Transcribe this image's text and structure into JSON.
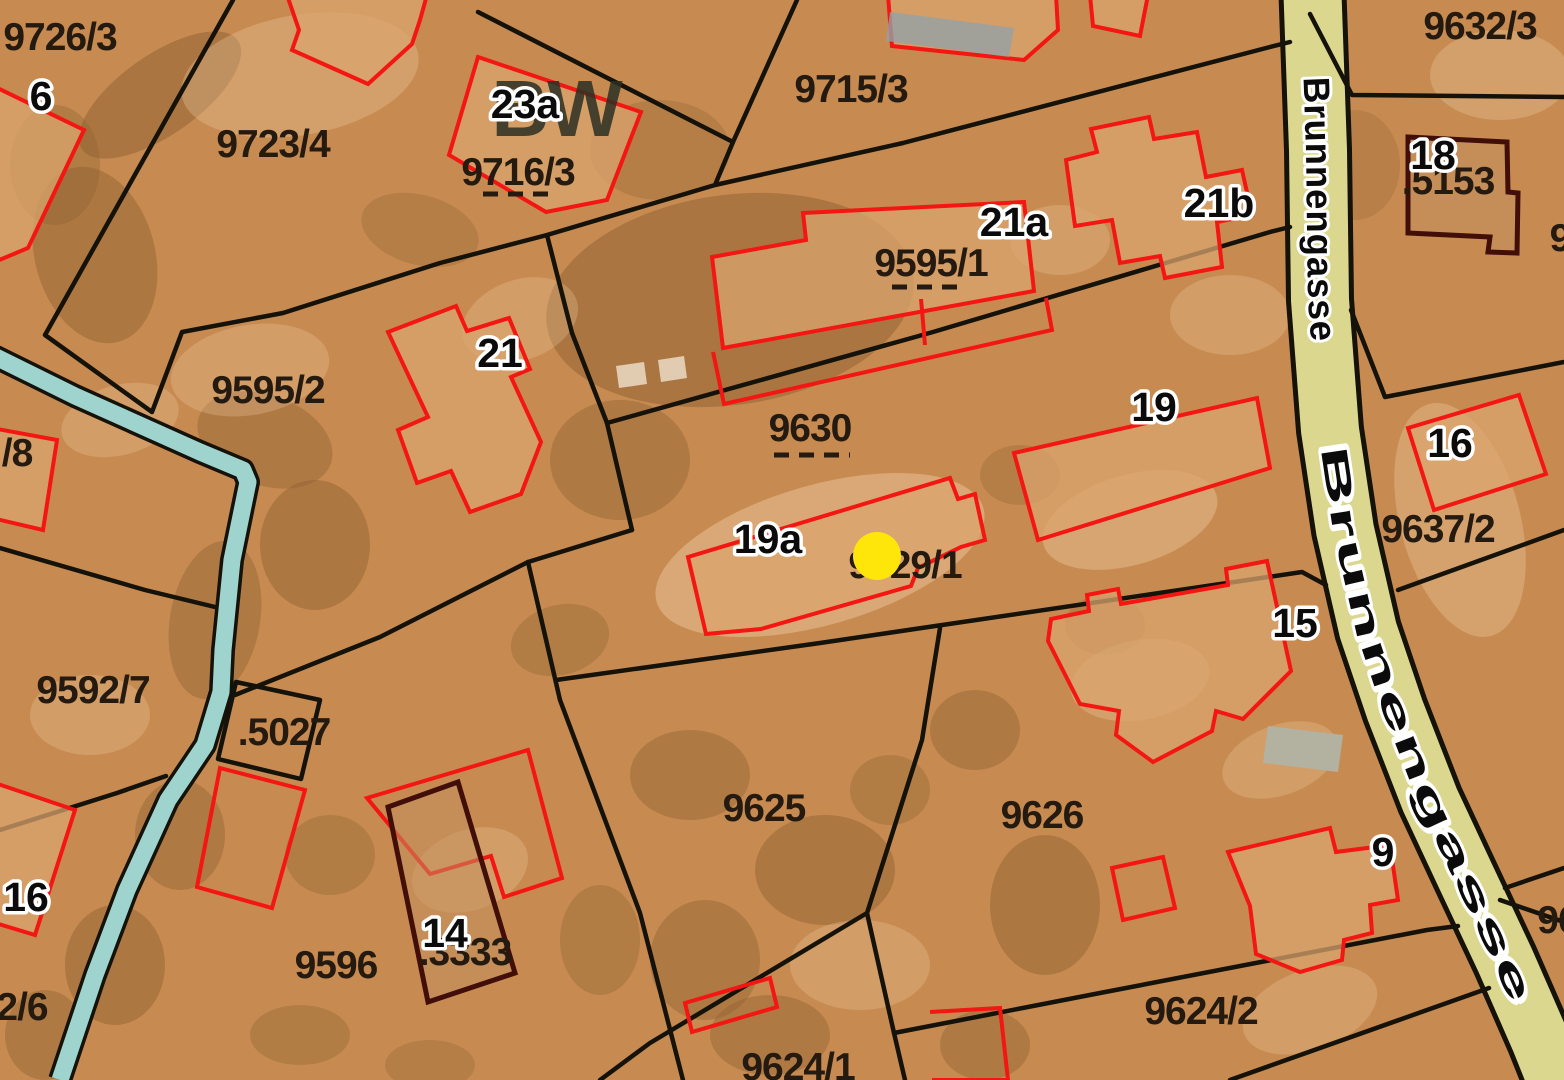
{
  "map": {
    "kind": "cadastral-parcel-map-with-orthophoto",
    "street": {
      "name": "Brunnengasse"
    },
    "overlay_text": {
      "bw": "BW"
    },
    "marker": {
      "shape": "circle",
      "color": "#ffe60a"
    },
    "colors": {
      "land": "#c78b51",
      "land_dark": "#8d6031",
      "land_light": "#ecc69b",
      "stream": "#9ed3ce",
      "street": "#dcd78f",
      "boundary": "#15120a",
      "building": "#f31613",
      "building_dark": "#420e08",
      "label": "#241a10",
      "halo": "#ffffff",
      "marker": "#ffe60a",
      "roof": "#daa46e",
      "pool": "#b3b1a0",
      "panels": "#93a0a6",
      "bw": "#2a2f23"
    },
    "parcels": [
      {
        "text": "9726/3",
        "dashed": false
      },
      {
        "text": "9723/4",
        "dashed": false
      },
      {
        "text": "9716/3",
        "dashed": true
      },
      {
        "text": "9715/3",
        "dashed": false
      },
      {
        "text": "9632/3",
        "dashed": false
      },
      {
        "text": ".5153",
        "dashed": false
      },
      {
        "text": "9595/1",
        "dashed": true
      },
      {
        "text": "9595/2",
        "dashed": false
      },
      {
        "text": "9630",
        "dashed": true
      },
      {
        "text": "/8",
        "dashed": false,
        "partial": true
      },
      {
        "text": "9637/2",
        "dashed": false
      },
      {
        "text": "9592/7",
        "dashed": false
      },
      {
        "text": ".5027",
        "dashed": false
      },
      {
        "text": "9629/1",
        "dashed": false
      },
      {
        "text": "9625",
        "dashed": false
      },
      {
        "text": "9626",
        "dashed": false
      },
      {
        "text": "9596",
        "dashed": false
      },
      {
        "text": ".3333",
        "dashed": false
      },
      {
        "text": "9624/1",
        "dashed": false,
        "partial": true
      },
      {
        "text": "9624/2",
        "dashed": false
      },
      {
        "text": "2/6",
        "dashed": false,
        "partial": true
      },
      {
        "text": "9",
        "dashed": false,
        "partial": true
      },
      {
        "text": "96",
        "dashed": false,
        "partial": true
      }
    ],
    "house_numbers": [
      {
        "text": "6"
      },
      {
        "text": "23a"
      },
      {
        "text": "21a"
      },
      {
        "text": "21b"
      },
      {
        "text": "21"
      },
      {
        "text": "18"
      },
      {
        "text": "16"
      },
      {
        "text": "19"
      },
      {
        "text": "19a"
      },
      {
        "text": "15"
      },
      {
        "text": "16"
      },
      {
        "text": "14"
      },
      {
        "text": "9"
      }
    ]
  }
}
